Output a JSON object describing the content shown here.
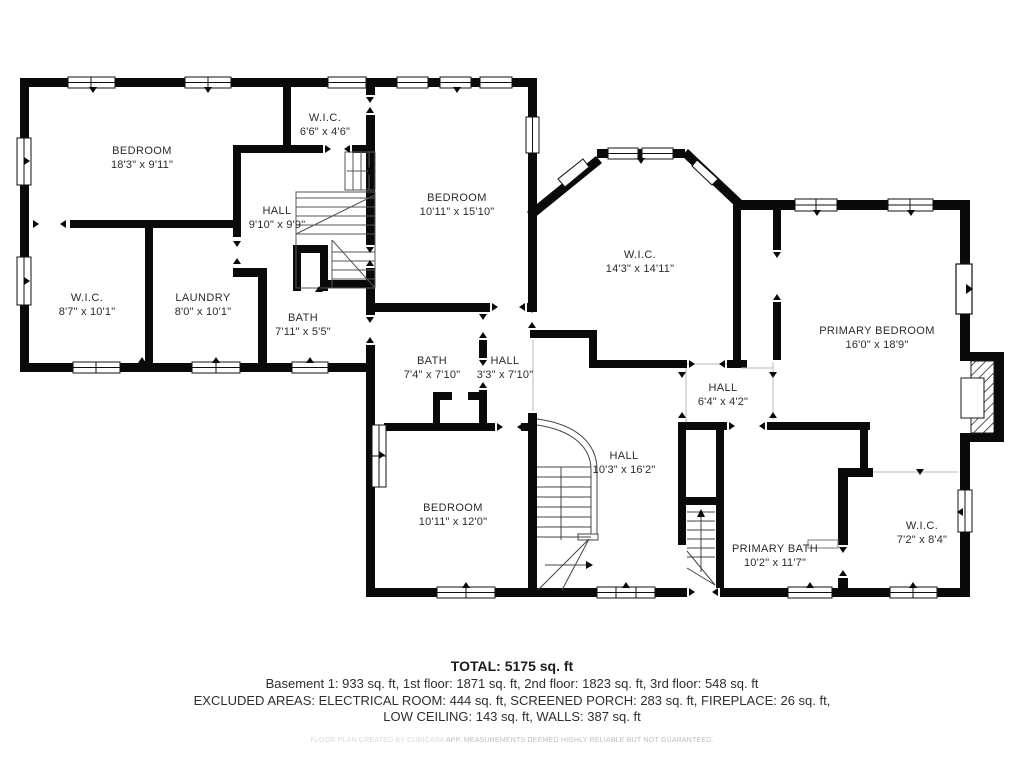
{
  "plan": {
    "rooms": [
      {
        "id": "bedroom-top-left",
        "name": "BEDROOM",
        "dims": "18'3\" x 9'11\""
      },
      {
        "id": "wic-66",
        "name": "W.I.C.",
        "dims": "6'6\" x 4'6\""
      },
      {
        "id": "hall-910",
        "name": "HALL",
        "dims": "9'10\" x 9'9\""
      },
      {
        "id": "wic-87",
        "name": "W.I.C.",
        "dims": "8'7\" x 10'1\""
      },
      {
        "id": "laundry",
        "name": "LAUNDRY",
        "dims": "8'0\" x 10'1\""
      },
      {
        "id": "bath-711",
        "name": "BATH",
        "dims": "7'11\" x 5'5\""
      },
      {
        "id": "bedroom-middle",
        "name": "BEDROOM",
        "dims": "10'11\" x 15'10\""
      },
      {
        "id": "wic-143",
        "name": "W.I.C.",
        "dims": "14'3\" x 14'11\""
      },
      {
        "id": "primary-bedroom",
        "name": "PRIMARY BEDROOM",
        "dims": "16'0\" x 18'9\""
      },
      {
        "id": "bath-74",
        "name": "BATH",
        "dims": "7'4\" x 7'10\""
      },
      {
        "id": "hall-33",
        "name": "HALL",
        "dims": "3'3\" x 7'10\""
      },
      {
        "id": "hall-64",
        "name": "HALL",
        "dims": "6'4\" x 4'2\""
      },
      {
        "id": "hall-103",
        "name": "HALL",
        "dims": "10'3\" x 16'2\""
      },
      {
        "id": "bedroom-bottom",
        "name": "BEDROOM",
        "dims": "10'11\" x 12'0\""
      },
      {
        "id": "primary-bath",
        "name": "PRIMARY BATH",
        "dims": "10'2\" x 11'7\""
      },
      {
        "id": "wic-72",
        "name": "W.I.C.",
        "dims": "7'2\" x 8'4\""
      }
    ],
    "summary": {
      "total": "TOTAL: 5175 sq. ft",
      "line1": "Basement 1: 933 sq. ft, 1st floor: 1871 sq. ft, 2nd floor: 1823 sq. ft, 3rd floor: 548 sq. ft",
      "line2": "EXCLUDED AREAS: ELECTRICAL ROOM: 444 sq. ft, SCREENED PORCH: 283 sq. ft, FIREPLACE: 26 sq. ft,",
      "line3": "LOW CEILING: 143 sq. ft, WALLS: 387 sq. ft",
      "disclaimer_left": "FLOOR PLAN CREATED BY CUBICASA ",
      "disclaimer_right": "APP. MEASUREMENTS DEEMED HIGHLY RELIABLE BUT NOT GUARANTEED."
    },
    "colors": {
      "wall": "#0a0a0a",
      "background": "#ffffff",
      "text": "#2b2b2b",
      "stair_line": "#555555",
      "disclaimer_text": "#bdbdbd"
    }
  }
}
